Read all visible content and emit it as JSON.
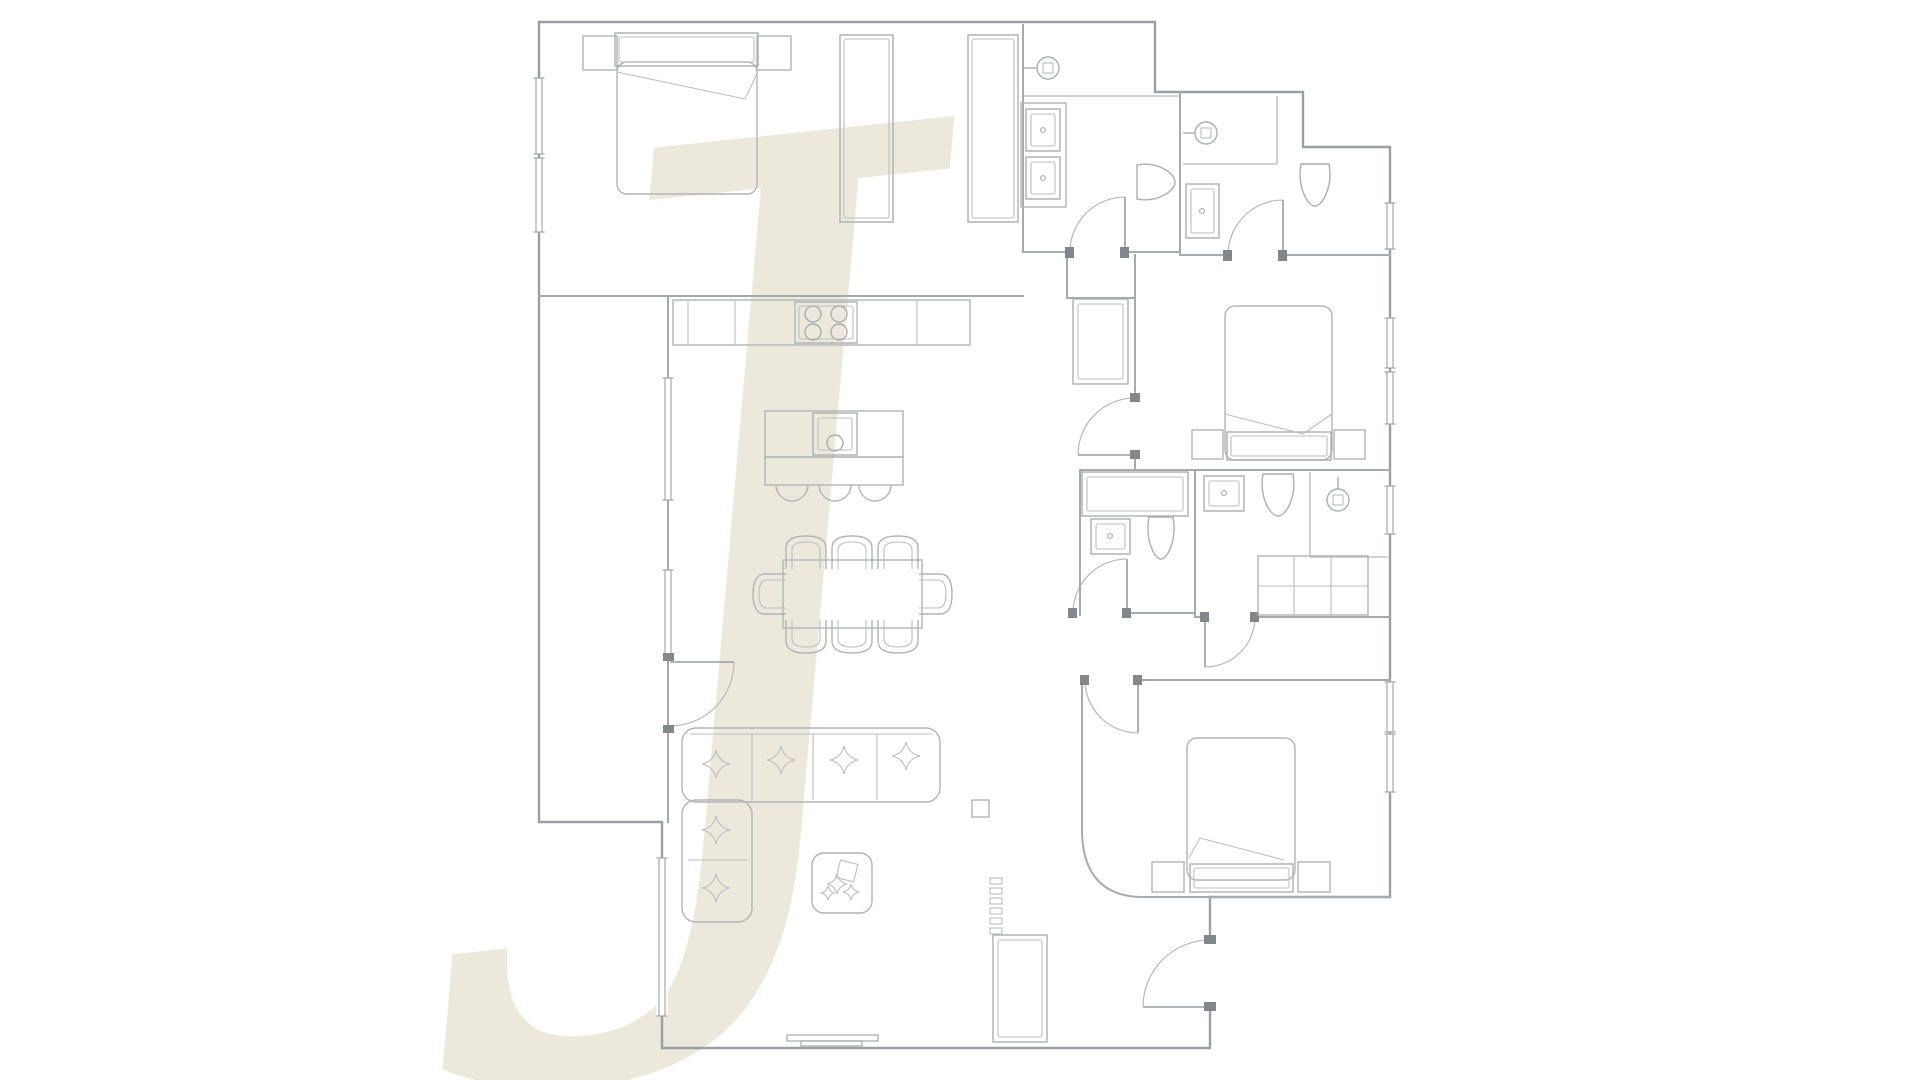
{
  "page": {
    "background": "#ffffff"
  },
  "colors": {
    "wall": "#9c9fa1",
    "wall_inner": "#a7aaac",
    "furniture": "#b2b4b6",
    "fixture": "#acaeb0",
    "door_frame": "#82878b",
    "watermark_beige": "#ece6d9"
  },
  "watermark": {
    "glyph": "J",
    "x": 590,
    "y": 880,
    "font_size": 990,
    "fill": "#ece6d9",
    "rotate": -6,
    "opacity": 0.9
  },
  "floorplan": {
    "viewbox": "0 0 1920 1080",
    "outer_walls": [
      {
        "name": "outer-wall-north-east",
        "d": "M539,22 H1155 V92 H1303 V147 H1390 V897 H1210 V940"
      },
      {
        "name": "outer-wall-south-west",
        "d": "M1210,1007 V1048 H662 V822 H539 V22"
      }
    ],
    "inner_walls": [
      {
        "name": "wall-masterbed-south",
        "d": "M539,296 H1023"
      },
      {
        "name": "wall-masterbath-west",
        "d": "M1023,25 V252"
      },
      {
        "name": "wall-masterbath-south-a",
        "d": "M1023,252 H1070"
      },
      {
        "name": "wall-masterbath-south-b",
        "d": "M1125,252 H1180"
      },
      {
        "name": "wall-baths-divider",
        "d": "M1180,92 V255"
      },
      {
        "name": "wall-bath2-south-a",
        "d": "M1180,255 H1228"
      },
      {
        "name": "wall-bath2-south-b",
        "d": "M1283,255 H1390"
      },
      {
        "name": "wall-bedroom2-west-a",
        "d": "M1135,255 V398"
      },
      {
        "name": "wall-bedroom2-west-b",
        "d": "M1135,455 V470"
      },
      {
        "name": "wall-hall-stub-v",
        "d": "M1067,252 V298"
      },
      {
        "name": "wall-hall-stub-h",
        "d": "M1067,298 H1135"
      },
      {
        "name": "wall-bedroom2-south",
        "d": "M1080,470 H1390"
      },
      {
        "name": "wall-living-east",
        "d": "M1080,470 V615"
      },
      {
        "name": "wall-bathA-south",
        "d": "M1127,613 H1195"
      },
      {
        "name": "wall-bathAB-divider",
        "d": "M1195,470 V617"
      },
      {
        "name": "wall-bathB-south-a",
        "d": "M1195,617 H1205"
      },
      {
        "name": "wall-bathB-south-b",
        "d": "M1255,617 H1390"
      },
      {
        "name": "wall-bedroom3-north",
        "d": "M1138,680 H1390"
      },
      {
        "name": "wall-bedroom3-west",
        "d": "M1082,680 V833"
      },
      {
        "name": "wall-bedroom3-curve",
        "d": "M1082,833 Q1084,895 1140,897"
      },
      {
        "name": "wall-bedroom3-south",
        "d": "M1140,897 H1390"
      },
      {
        "name": "wall-terrace-east",
        "d": "M668,296 V822"
      }
    ],
    "thin_lines": [
      {
        "name": "master-shower-edge",
        "d": "M1023,96 H1180"
      },
      {
        "name": "bath2-shower-edge-h",
        "d": "M1183,164 H1277"
      },
      {
        "name": "bath2-shower-edge-v",
        "d": "M1277,96 V164"
      },
      {
        "name": "bathB-shower-edge-v",
        "d": "M1310,472 V557"
      },
      {
        "name": "bathB-shower-edge-h",
        "d": "M1310,557 H1388"
      }
    ],
    "windows": [
      {
        "name": "window-masterbed-1",
        "x": 539,
        "y": 78,
        "len": 76
      },
      {
        "name": "window-masterbed-2",
        "x": 539,
        "y": 158,
        "len": 74
      },
      {
        "name": "window-living-1",
        "x": 668,
        "y": 378,
        "len": 122
      },
      {
        "name": "window-living-2",
        "x": 668,
        "y": 570,
        "len": 84
      },
      {
        "name": "window-living-3",
        "x": 662,
        "y": 858,
        "len": 158
      },
      {
        "name": "window-bath2",
        "x": 1390,
        "y": 203,
        "len": 46
      },
      {
        "name": "window-bedroom2-1",
        "x": 1390,
        "y": 318,
        "len": 50
      },
      {
        "name": "window-bedroom2-2",
        "x": 1390,
        "y": 372,
        "len": 52
      },
      {
        "name": "window-bathB",
        "x": 1390,
        "y": 486,
        "len": 48
      },
      {
        "name": "window-bedroom3-1",
        "x": 1390,
        "y": 682,
        "len": 50
      },
      {
        "name": "window-bedroom3-2",
        "x": 1390,
        "y": 734,
        "len": 58
      }
    ],
    "doors": [
      {
        "name": "door-terrace",
        "leaf": "M670,662 H734",
        "arc": "M670,726 A64,64 0 0 0 734,662",
        "jambs": [
          [
            663,
            653,
            11,
            8
          ],
          [
            663,
            725,
            11,
            8
          ]
        ]
      },
      {
        "name": "door-masterbath",
        "leaf": "M1125,252 V197",
        "arc": "M1070,252 A55,55 0 0 1 1125,197",
        "jambs": [
          [
            1065,
            247,
            9,
            11
          ],
          [
            1120,
            247,
            9,
            11
          ]
        ]
      },
      {
        "name": "door-bath2",
        "leaf": "M1283,255 V200",
        "arc": "M1228,255 A55,55 0 0 1 1283,200",
        "jambs": [
          [
            1223,
            250,
            9,
            11
          ],
          [
            1278,
            250,
            9,
            11
          ]
        ]
      },
      {
        "name": "door-bedroom2",
        "leaf": "M1135,455 H1078",
        "arc": "M1135,398 A57,57 0 0 0 1078,455",
        "jambs": [
          [
            1130,
            393,
            10,
            9
          ],
          [
            1130,
            450,
            10,
            9
          ]
        ]
      },
      {
        "name": "door-bathA",
        "leaf": "M1127,613 V559",
        "arc": "M1073,613 A54,54 0 0 1 1127,559",
        "jambs": [
          [
            1068,
            608,
            9,
            10
          ],
          [
            1122,
            608,
            9,
            10
          ]
        ]
      },
      {
        "name": "door-bathB",
        "leaf": "M1205,617 V667",
        "arc": "M1255,617 A50,50 0 0 1 1205,667",
        "jambs": [
          [
            1200,
            612,
            9,
            10
          ],
          [
            1250,
            612,
            9,
            10
          ]
        ]
      },
      {
        "name": "door-bedroom3",
        "leaf": "M1138,680 V733",
        "arc": "M1085,680 A53,53 0 0 0 1138,733",
        "jambs": [
          [
            1080,
            675,
            9,
            10
          ],
          [
            1133,
            675,
            9,
            10
          ]
        ]
      },
      {
        "name": "door-entry",
        "leaf": "M1210,1007 H1143",
        "arc": "M1210,940 A67,67 0 0 0 1143,1007",
        "jambs": [
          [
            1204,
            935,
            12,
            9
          ],
          [
            1204,
            1002,
            12,
            9
          ]
        ]
      }
    ],
    "pair_rects": [
      {
        "name": "wardrobe-a",
        "x": 840,
        "y": 35,
        "w": 53,
        "h": 187,
        "inset": 4
      },
      {
        "name": "wardrobe-b",
        "x": 968,
        "y": 35,
        "w": 50,
        "h": 187,
        "inset": 4
      },
      {
        "name": "headboard-master",
        "x": 615,
        "y": 33,
        "w": 143,
        "h": 33,
        "inset": 4
      },
      {
        "name": "headboard-bed2",
        "x": 1227,
        "y": 432,
        "w": 104,
        "h": 28,
        "inset": 4
      },
      {
        "name": "headboard-bed3",
        "x": 1190,
        "y": 864,
        "w": 103,
        "h": 28,
        "inset": 4
      },
      {
        "name": "island-sink",
        "x": 813,
        "y": 413,
        "w": 44,
        "h": 42,
        "inset": 5
      },
      {
        "name": "hall-closet",
        "x": 1073,
        "y": 299,
        "w": 55,
        "h": 85,
        "inset": 5
      },
      {
        "name": "bathA-cabinet",
        "x": 1082,
        "y": 472,
        "w": 106,
        "h": 44,
        "inset": 5
      },
      {
        "name": "entry-cabinet",
        "x": 993,
        "y": 935,
        "w": 54,
        "h": 107,
        "inset": 5
      },
      {
        "name": "cooktop",
        "x": 795,
        "y": 302,
        "w": 62,
        "h": 41,
        "inset": 4
      },
      {
        "name": "vanity-sink-1",
        "x": 1026,
        "y": 109,
        "w": 34,
        "h": 42,
        "inset": 5
      },
      {
        "name": "vanity-sink-2",
        "x": 1026,
        "y": 157,
        "w": 34,
        "h": 42,
        "inset": 5
      },
      {
        "name": "sink-bath2",
        "x": 1186,
        "y": 184,
        "w": 33,
        "h": 54,
        "inset": 5
      },
      {
        "name": "sink-bathA",
        "x": 1091,
        "y": 519,
        "w": 39,
        "h": 35,
        "inset": 5
      },
      {
        "name": "sink-bathB",
        "x": 1204,
        "y": 476,
        "w": 40,
        "h": 35,
        "inset": 5
      }
    ],
    "rects": [
      {
        "name": "nightstand-master-l",
        "x": 583,
        "y": 36,
        "w": 34,
        "h": 34
      },
      {
        "name": "nightstand-master-r",
        "x": 757,
        "y": 36,
        "w": 34,
        "h": 34
      },
      {
        "name": "nightstand-bed2-l",
        "x": 1192,
        "y": 430,
        "w": 31,
        "h": 29
      },
      {
        "name": "nightstand-bed2-r",
        "x": 1334,
        "y": 430,
        "w": 31,
        "h": 29
      },
      {
        "name": "nightstand-bed3-l",
        "x": 1152,
        "y": 862,
        "w": 32,
        "h": 30
      },
      {
        "name": "nightstand-bed3-r",
        "x": 1298,
        "y": 862,
        "w": 32,
        "h": 30
      },
      {
        "name": "kitchen-counter",
        "x": 673,
        "y": 300,
        "w": 297,
        "h": 45
      },
      {
        "name": "kitchen-island",
        "x": 765,
        "y": 411,
        "w": 138,
        "h": 46
      },
      {
        "name": "island-overhang",
        "x": 765,
        "y": 457,
        "w": 138,
        "h": 28
      },
      {
        "name": "vanity-counter",
        "x": 1021,
        "y": 103,
        "w": 45,
        "h": 104
      },
      {
        "name": "laundry-cabinet",
        "x": 1258,
        "y": 556,
        "w": 110,
        "h": 59
      },
      {
        "name": "floor-box",
        "x": 972,
        "y": 800,
        "w": 17,
        "h": 17
      },
      {
        "name": "sliding-door-1",
        "x": 787,
        "y": 1035,
        "w": 91,
        "h": 6
      },
      {
        "name": "sliding-door-2",
        "x": 801,
        "y": 1041,
        "w": 61,
        "h": 5
      },
      {
        "name": "dining-table",
        "x": 783,
        "y": 560,
        "w": 139,
        "h": 68
      },
      {
        "name": "mattress-master",
        "x": 617,
        "y": 62,
        "w": 140,
        "h": 132,
        "rx": 10
      },
      {
        "name": "mattress-bed2",
        "x": 1225,
        "y": 306,
        "w": 107,
        "h": 154,
        "rx": 10
      },
      {
        "name": "mattress-bed3",
        "x": 1187,
        "y": 738,
        "w": 108,
        "h": 142,
        "rx": 10
      },
      {
        "name": "sofa-section-h",
        "x": 682,
        "y": 728,
        "w": 258,
        "h": 74,
        "rx": 14
      },
      {
        "name": "sofa-section-v",
        "x": 682,
        "y": 800,
        "w": 70,
        "h": 122,
        "rx": 14
      },
      {
        "name": "coffee-table",
        "x": 812,
        "y": 853,
        "w": 60,
        "h": 60,
        "rx": 12
      }
    ],
    "detail_paths": [
      {
        "name": "counter-divider-1",
        "d": "M688,300 V345"
      },
      {
        "name": "counter-divider-2",
        "d": "M735,300 V345"
      },
      {
        "name": "counter-divider-3",
        "d": "M795,300 V345"
      },
      {
        "name": "counter-divider-4",
        "d": "M857,300 V345"
      },
      {
        "name": "counter-divider-5",
        "d": "M917,300 V345"
      },
      {
        "name": "laundry-grid-v1",
        "d": "M1294,556 V615"
      },
      {
        "name": "laundry-grid-v2",
        "d": "M1331,556 V615"
      },
      {
        "name": "laundry-grid-h",
        "d": "M1258,586 H1368"
      },
      {
        "name": "sofa-divider-1",
        "d": "M752,734 V800"
      },
      {
        "name": "sofa-divider-2",
        "d": "M813,734 V800"
      },
      {
        "name": "sofa-divider-3",
        "d": "M877,734 V800"
      },
      {
        "name": "sofa-back-line",
        "d": "M690,734 H932"
      },
      {
        "name": "sofa-divider-4",
        "d": "M688,860 H748"
      },
      {
        "name": "bed-master-fold-1",
        "d": "M617,72 L745,99"
      },
      {
        "name": "bed-master-fold-2",
        "d": "M745,99 L757,74"
      },
      {
        "name": "bed2-fold-1",
        "d": "M1225,414 L1303,434"
      },
      {
        "name": "bed2-fold-2",
        "d": "M1303,434 L1332,414"
      },
      {
        "name": "bed3-fold-1",
        "d": "M1189,858 L1200,838"
      },
      {
        "name": "bed3-fold-2",
        "d": "M1200,838 L1284,860"
      }
    ],
    "stool_arcs": [
      {
        "name": "stool-1",
        "d": "M776,485 A16,16 0 0 0 808,485"
      },
      {
        "name": "stool-2",
        "d": "M819,485 A16,16 0 0 0 851,485"
      },
      {
        "name": "stool-3",
        "d": "M859,485 A16,16 0 0 0 891,485"
      }
    ],
    "circles": [
      {
        "name": "burner-1",
        "cx": 813,
        "cy": 314,
        "r": 8
      },
      {
        "name": "burner-2",
        "cx": 839,
        "cy": 314,
        "r": 8
      },
      {
        "name": "burner-3",
        "cx": 813,
        "cy": 332,
        "r": 8
      },
      {
        "name": "burner-4",
        "cx": 839,
        "cy": 332,
        "r": 8
      },
      {
        "name": "island-faucet",
        "cx": 835,
        "cy": 443,
        "r": 8
      }
    ],
    "dots": [
      {
        "name": "sink-dot",
        "cx": 1043,
        "cy": 130,
        "r": 2.4
      },
      {
        "name": "sink-dot",
        "cx": 1043,
        "cy": 178,
        "r": 2.4
      },
      {
        "name": "sink-dot",
        "cx": 1202,
        "cy": 211,
        "r": 2.4
      },
      {
        "name": "sink-dot",
        "cx": 1110,
        "cy": 536,
        "r": 2.4
      },
      {
        "name": "sink-dot",
        "cx": 1224,
        "cy": 493,
        "r": 2.4
      }
    ],
    "showers": [
      {
        "name": "shower-head-master",
        "cx": 1048,
        "cy": 68,
        "r": 11,
        "arm": "M1023,68 H1037"
      },
      {
        "name": "shower-head-bath2",
        "cx": 1206,
        "cy": 133,
        "r": 11,
        "arm": "M1183,133 H1195"
      },
      {
        "name": "shower-head-bathB",
        "cx": 1338,
        "cy": 500,
        "r": 11,
        "arm": "M1338,477 V489"
      }
    ],
    "toilets": [
      {
        "name": "toilet-masterbath",
        "x": 1137,
        "y": 162,
        "w": 38,
        "h": 40,
        "flat": "left"
      },
      {
        "name": "toilet-bath2",
        "x": 1298,
        "y": 164,
        "w": 34,
        "h": 42,
        "flat": "top"
      },
      {
        "name": "toilet-bathA",
        "x": 1146,
        "y": 517,
        "w": 30,
        "h": 42,
        "flat": "top"
      },
      {
        "name": "toilet-bathB",
        "x": 1260,
        "y": 474,
        "w": 36,
        "h": 42,
        "flat": "top"
      }
    ],
    "chairs": [
      {
        "name": "dining-chair",
        "cx": 806,
        "cy": 553,
        "rot": 0
      },
      {
        "name": "dining-chair",
        "cx": 852,
        "cy": 553,
        "rot": 0
      },
      {
        "name": "dining-chair",
        "cx": 898,
        "cy": 553,
        "rot": 0
      },
      {
        "name": "dining-chair",
        "cx": 806,
        "cy": 636,
        "rot": 180
      },
      {
        "name": "dining-chair",
        "cx": 852,
        "cy": 636,
        "rot": 180
      },
      {
        "name": "dining-chair",
        "cx": 898,
        "cy": 636,
        "rot": 180
      },
      {
        "name": "dining-chair",
        "cx": 770,
        "cy": 594,
        "rot": -90
      },
      {
        "name": "dining-chair",
        "cx": 935,
        "cy": 594,
        "rot": 90
      }
    ],
    "pillows": [
      {
        "name": "pillow-star",
        "x": 716,
        "y": 764,
        "r": 14
      },
      {
        "name": "pillow-star",
        "x": 781,
        "y": 760,
        "r": 14
      },
      {
        "name": "pillow-star",
        "x": 844,
        "y": 760,
        "r": 14
      },
      {
        "name": "pillow-star",
        "x": 906,
        "y": 756,
        "r": 14
      },
      {
        "name": "pillow-star",
        "x": 716,
        "y": 830,
        "r": 14
      },
      {
        "name": "pillow-star",
        "x": 716,
        "y": 888,
        "r": 14
      },
      {
        "name": "plant-leaf",
        "x": 837,
        "y": 884,
        "r": 10
      },
      {
        "name": "plant-leaf",
        "x": 851,
        "y": 892,
        "r": 8
      },
      {
        "name": "plant-leaf",
        "x": 828,
        "y": 893,
        "r": 7
      }
    ],
    "plant_pot": {
      "name": "plant-pot",
      "x": 838,
      "y": 862,
      "w": 18,
      "h": 18,
      "rot": 14
    },
    "radiator": {
      "name": "radiator-segment",
      "x": 990,
      "y_start": 878,
      "step": 10,
      "count": 6,
      "w": 12,
      "h": 6
    }
  }
}
